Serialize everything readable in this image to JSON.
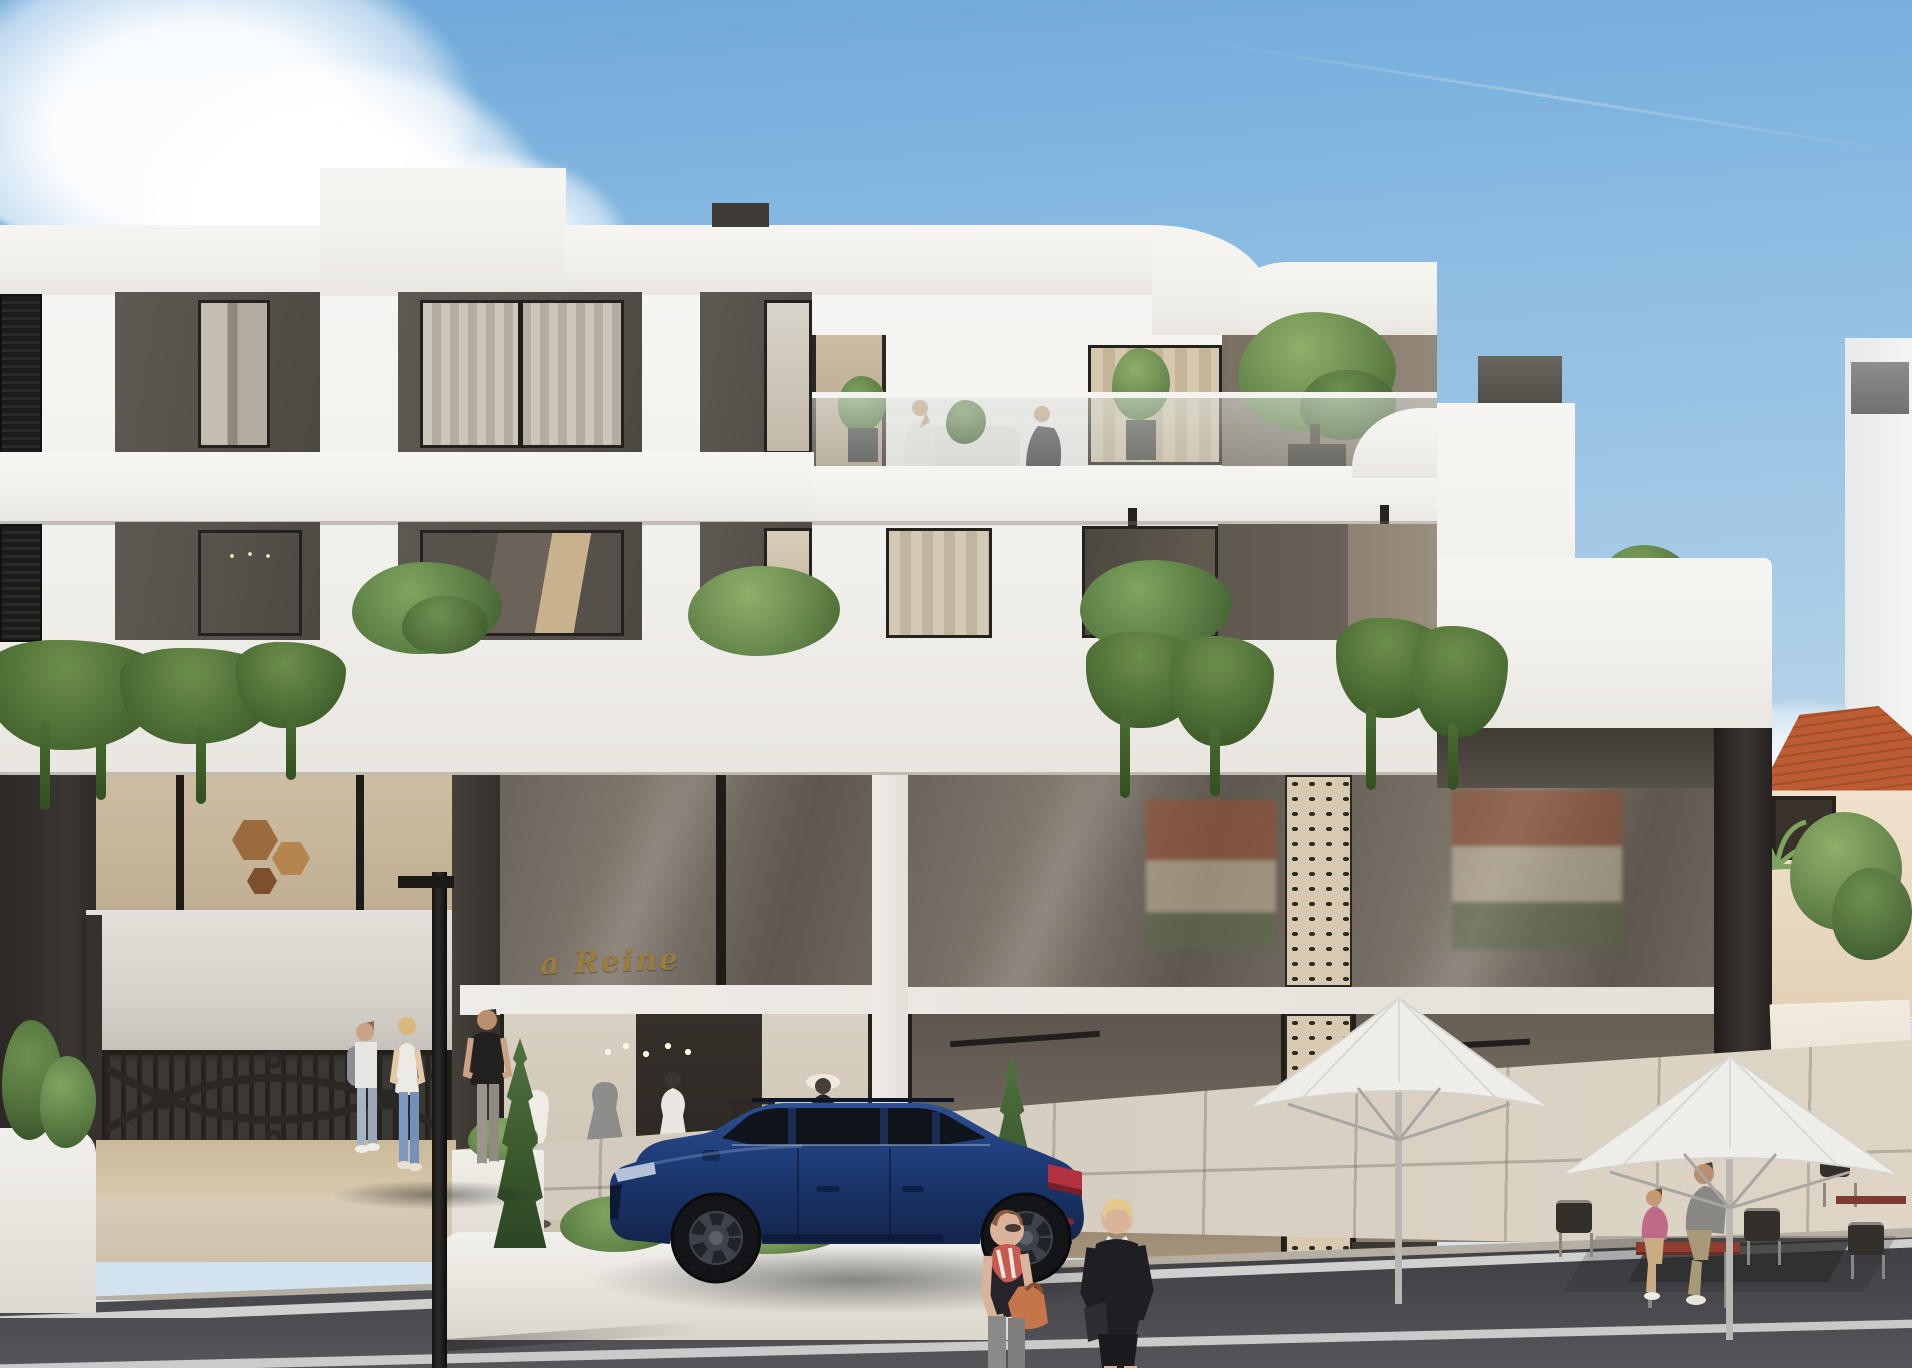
{
  "signage": {
    "boutique_sign": "a Reine"
  },
  "palette": {
    "sky_top": "#6ca8d9",
    "sky_mid": "#a9cce6",
    "sky_bottom": "#dce9f1",
    "facade_white": "#f2f0ec",
    "panel_dark": "#56524b",
    "panel_taupe": "#8e8476",
    "glass_warm": "#cbbaa2",
    "lattice_beige": "#d8cab0",
    "sign_gold": "#9a7b40",
    "car_blue": "#1d3a74",
    "roof_terracotta": "#bd5c33",
    "asphalt": "#46464a",
    "sidewalk": "#cfc8bb",
    "travertine": "#d9cdb7",
    "curb": "#b5aea2",
    "line_white": "#e9e9e7",
    "green_dark": "#3f5c35",
    "green_mid": "#5f7c48",
    "umbrella_white": "#efede8",
    "gate_metal": "#2a2724",
    "table_red": "#8e3b30",
    "bag_orange": "#c4764a"
  }
}
